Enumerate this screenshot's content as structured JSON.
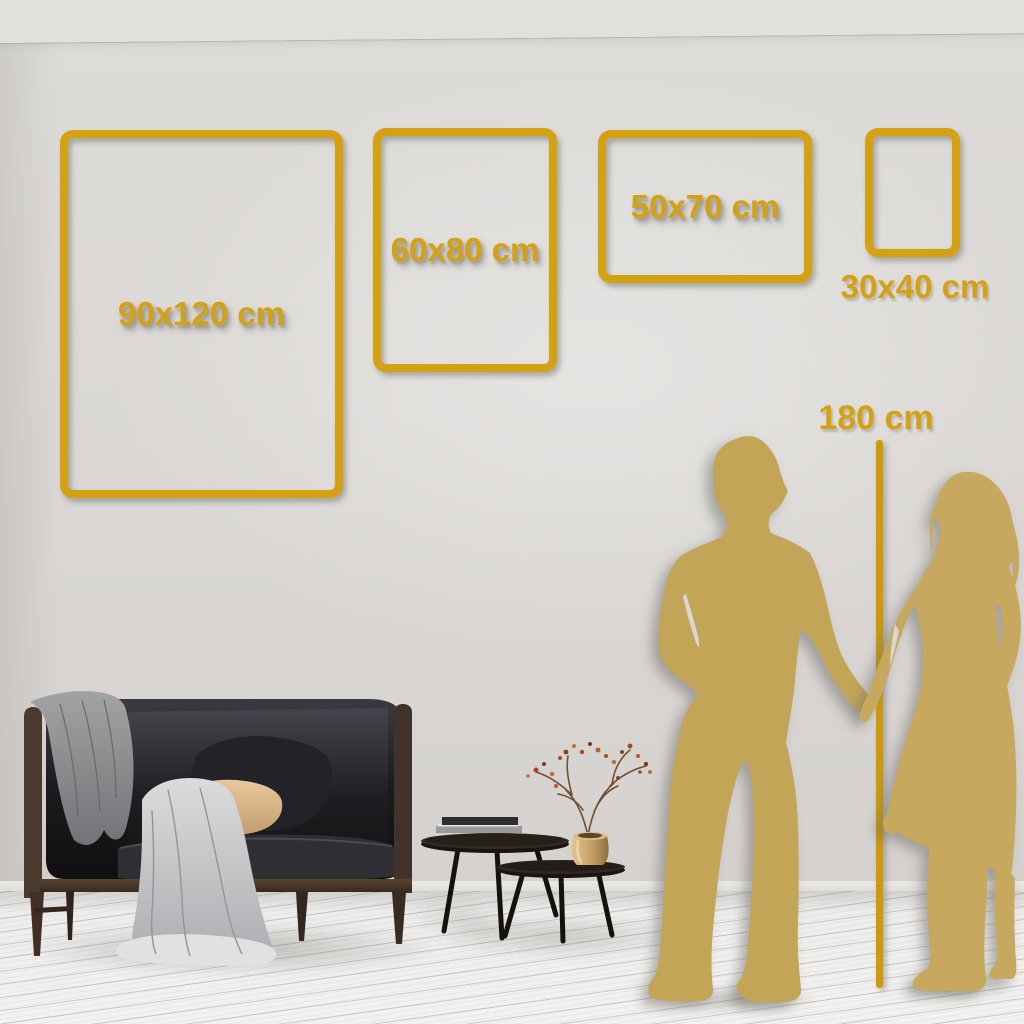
{
  "scene": {
    "frames": [
      {
        "id": "90x120",
        "label": "90x120 cm"
      },
      {
        "id": "60x80",
        "label": "60x80 cm"
      },
      {
        "id": "50x70",
        "label": "50x70 cm"
      },
      {
        "id": "30x40",
        "label": "30x40 cm"
      }
    ],
    "height_reference": {
      "label": "180 cm"
    },
    "colors": {
      "accent_gold": "#D3A112",
      "ruler_gold": "#CC9A0C",
      "silhouette_gold": "#C5A75A",
      "wall": "#DAD7D4",
      "floor": "#F0EFED",
      "sofa_velvet": "#1A1A1D",
      "wood": "#46382E",
      "gray_blanket": "#8E8E90",
      "white_throw": "#D2D3D5",
      "tan_pillow": "#DCBE92",
      "vase_brass": "#C9A96E",
      "berries": "#A8491C"
    },
    "objects": {
      "sofa": "velvet-loveseat",
      "blanket": "gray-throw-blanket",
      "throw": "light-draped-throw",
      "tables": "nesting-coffee-tables",
      "vase": "brass-vase-dried-branch",
      "books": "stacked-books",
      "man": "man-silhouette",
      "woman": "woman-silhouette"
    }
  }
}
